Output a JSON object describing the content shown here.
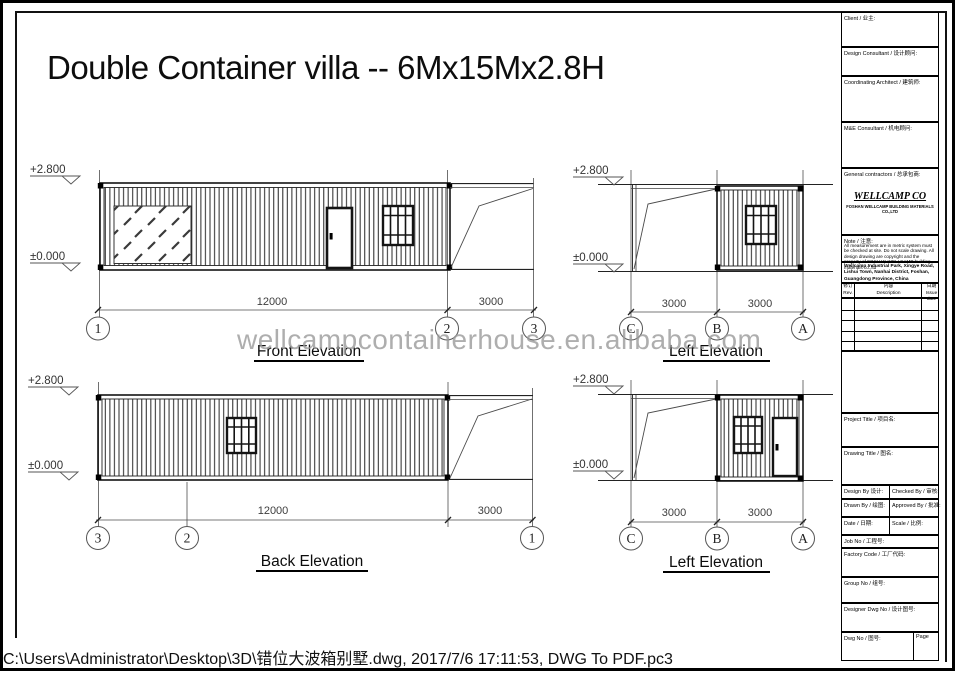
{
  "page": {
    "title": "Double Container villa -- 6Mx15Mx2.8H",
    "watermark": "wellcampcontainerhouse.en.alibaba.com",
    "plot_stamp": "C:\\Users\\Administrator\\Desktop\\3D\\错位大波箱别墅.dwg, 2017/7/6 17:11:53, DWG To PDF.pc3"
  },
  "levels": {
    "top": "+2.800",
    "ground": "±0.000"
  },
  "elevations": {
    "front": {
      "label": "Front Elevation",
      "dims": [
        "12000",
        "3000"
      ],
      "grids": [
        "1",
        "2",
        "3"
      ]
    },
    "left_top": {
      "label": "Left Elevation",
      "dims": [
        "3000",
        "3000"
      ],
      "grids": [
        "C",
        "B",
        "A"
      ]
    },
    "back": {
      "label": "Back Elevation",
      "dims": [
        "12000",
        "3000"
      ],
      "grids": [
        "3",
        "2",
        "1"
      ]
    },
    "left_bottom": {
      "label": "Left Elevation",
      "dims": [
        "3000",
        "3000"
      ],
      "grids": [
        "C",
        "B",
        "A"
      ]
    }
  },
  "title_block": {
    "client_label": "Client / 业主:",
    "design_consultant_label": "Design Consultant / 设计顾问:",
    "coordinating_architect_label": "Coordinating Architect / 建筑师:",
    "me_consultant_label": "M&E Consultant / 机电顾问:",
    "general_contractors_label": "General contractors / 总承包商:",
    "company_name": "WELLCAMP CO",
    "company_subline": "FOSHAN WELLCAMP BUILDING MATERIALS CO.,LTD",
    "note_label": "Note / 注意:",
    "note_text": "All measurement are in metric system must be checked at site. Do not scale drawing. All design drawing are copyright and the property of FOSHAN WELLCAMP building materials co.,ltd",
    "address_lines": [
      "Wellcamp Industrial Park, Xingye Road,",
      "Lishui Town, Nanhai District, Foshan,",
      "Guangdong Province, China"
    ],
    "rev_header": {
      "rev_cn": "修订",
      "rev_en": "Rev.",
      "desc_cn": "内容",
      "desc_en": "Description",
      "date_cn": "日期",
      "date_en": "Issue date"
    },
    "project_title_label": "Project Title / 项目名:",
    "drawing_title_label": "Drawing Title / 图名:",
    "design_by_label": "Design By 设计:",
    "checked_by_label": "Checked By / 审核:",
    "drawn_by_label": "Drawn By / 绘图:",
    "approved_by_label": "Approved By / 批准:",
    "date_label": "Date / 日期:",
    "scale_label": "Scale / 比例:",
    "job_no_label": "Job No / 工程号:",
    "factory_code_label": "Factory Code / 工厂代码:",
    "group_no_label": "Group No / 组号:",
    "designer_dwg_label": "Designer Dwg No / 设计图号:",
    "dwg_no_label": "Dwg No / 图号:",
    "page_label": "Page"
  }
}
